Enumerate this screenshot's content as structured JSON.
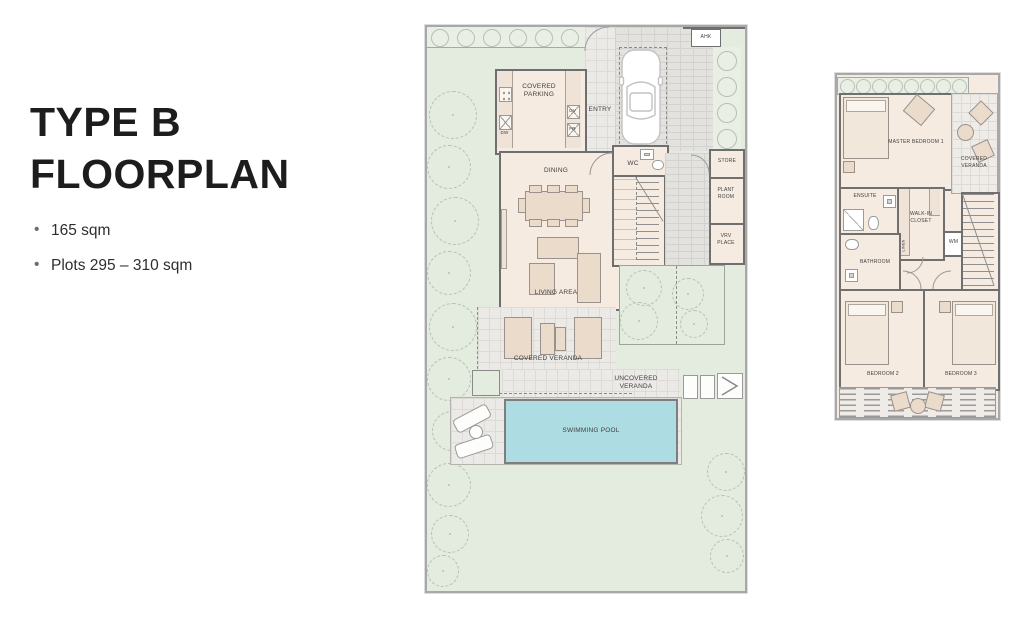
{
  "panel": {
    "title_line1": "TYPE B",
    "title_line2": "FLOORPLAN",
    "bullets": [
      "165 sqm",
      "Plots 295 – 310 sqm"
    ]
  },
  "ground_floor": {
    "labels": {
      "ahk": "AHK",
      "covered_parking": "COVERED PARKING",
      "entry": "ENTRY",
      "kitchen": "KITCHEN",
      "dw": "DW",
      "ov": "OV",
      "fr": "FR",
      "dining": "DINING",
      "wc": "WC",
      "store": "STORE",
      "plant_room": "PLANT ROOM",
      "vrv_place": "VRV PLACE",
      "living_area": "LIVING AREA",
      "covered_veranda": "COVERED VERANDA",
      "uncovered_veranda": "UNCOVERED VERANDA",
      "swimming_pool": "SWIMMING POOL"
    }
  },
  "upper_floor": {
    "labels": {
      "master_bedroom": "MASTER BEDROOM 1",
      "covered_veranda": "COVERED VERANDA",
      "ensuite": "ENSUITE",
      "walk_in_closet": "WALK-IN CLOSET",
      "wm": "WM",
      "linen": "LINEN",
      "bathroom": "BATHROOM",
      "bedroom_2": "BEDROOM 2",
      "bedroom_3": "BEDROOM 3"
    }
  },
  "colors": {
    "garden": "#e4ebdf",
    "interior": "#f5ebe1",
    "pool": "#aedce3",
    "wall": "#6f6f6f",
    "furniture": "#eadbcb",
    "paving": "#e8e6e3"
  }
}
